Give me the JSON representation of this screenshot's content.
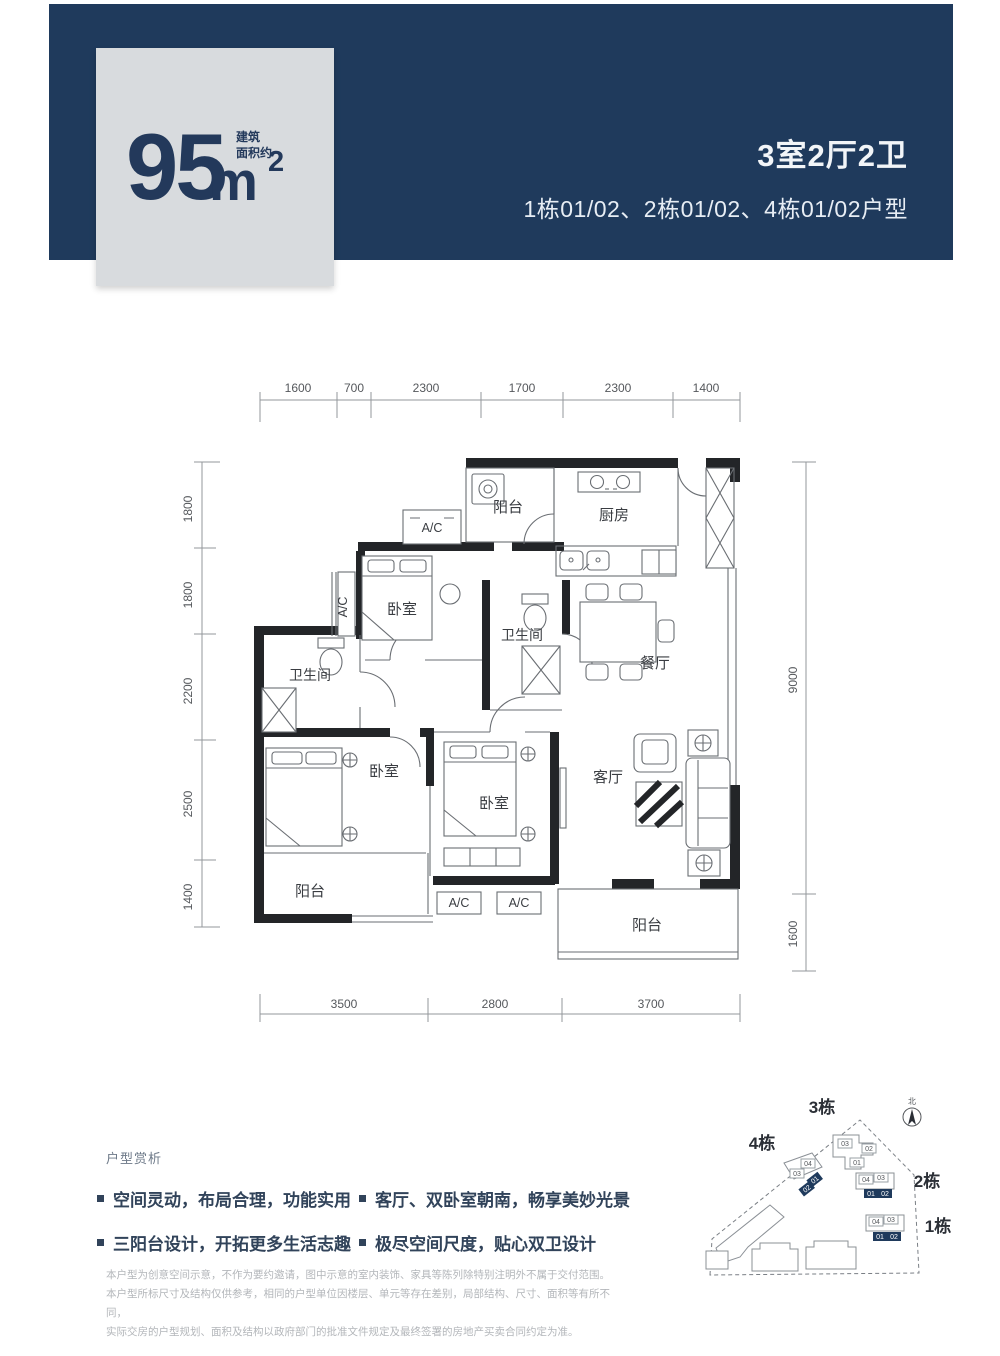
{
  "header": {
    "area_value": "95",
    "area_unit": "m",
    "area_sup": "2",
    "area_note_line1": "建筑",
    "area_note_line2": "面积约",
    "apartment_type": "3室2厅2卫",
    "apartment_units": "1栋01/02、2栋01/02、4栋01/02户型"
  },
  "floorplan": {
    "dims": {
      "top": [
        "1600",
        "700",
        "2300",
        "1700",
        "2300",
        "1400"
      ],
      "left": [
        "1800",
        "1800",
        "2200",
        "2500",
        "1400"
      ],
      "right": [
        "9000",
        "1600"
      ],
      "bottom": [
        "3500",
        "2800",
        "3700"
      ]
    },
    "rooms": {
      "balcony": "阳台",
      "kitchen": "厨房",
      "bedroom": "卧室",
      "bathroom": "卫生间",
      "dining": "餐厅",
      "living": "客厅",
      "ac": "A/C"
    }
  },
  "analysis": {
    "title": "户型赏析",
    "bullets": [
      "空间灵动，布局合理，功能实用",
      "三阳台设计，开拓更多生活志趣",
      "客厅、双卧室朝南，畅享美妙光景",
      "极尽空间尺度，贴心双卫设计"
    ]
  },
  "site_plan": {
    "north": "北",
    "building_labels": [
      "3栋",
      "4栋",
      "2栋",
      "1栋"
    ],
    "units": {
      "u01": "01",
      "u02": "02",
      "u03": "03",
      "u04": "04"
    }
  },
  "disclaimer": [
    "本户型为创意空间示意，不作为要约邀请，图中示意的室内装饰、家具等陈列除特别注明外不属于交付范围。",
    "本户型所标尺寸及结构仅供参考，相同的户型单位因楼层、单元等存在差别，局部结构、尺寸、面积等有所不同，",
    "实际交房的户型规划、面积及结构以政府部门的批准文件规定及最终签署的房地产买卖合同约定为准。"
  ],
  "colors": {
    "navy": "#1f3a5c",
    "card_gray": "#d8dbde",
    "wall": "#232528"
  }
}
